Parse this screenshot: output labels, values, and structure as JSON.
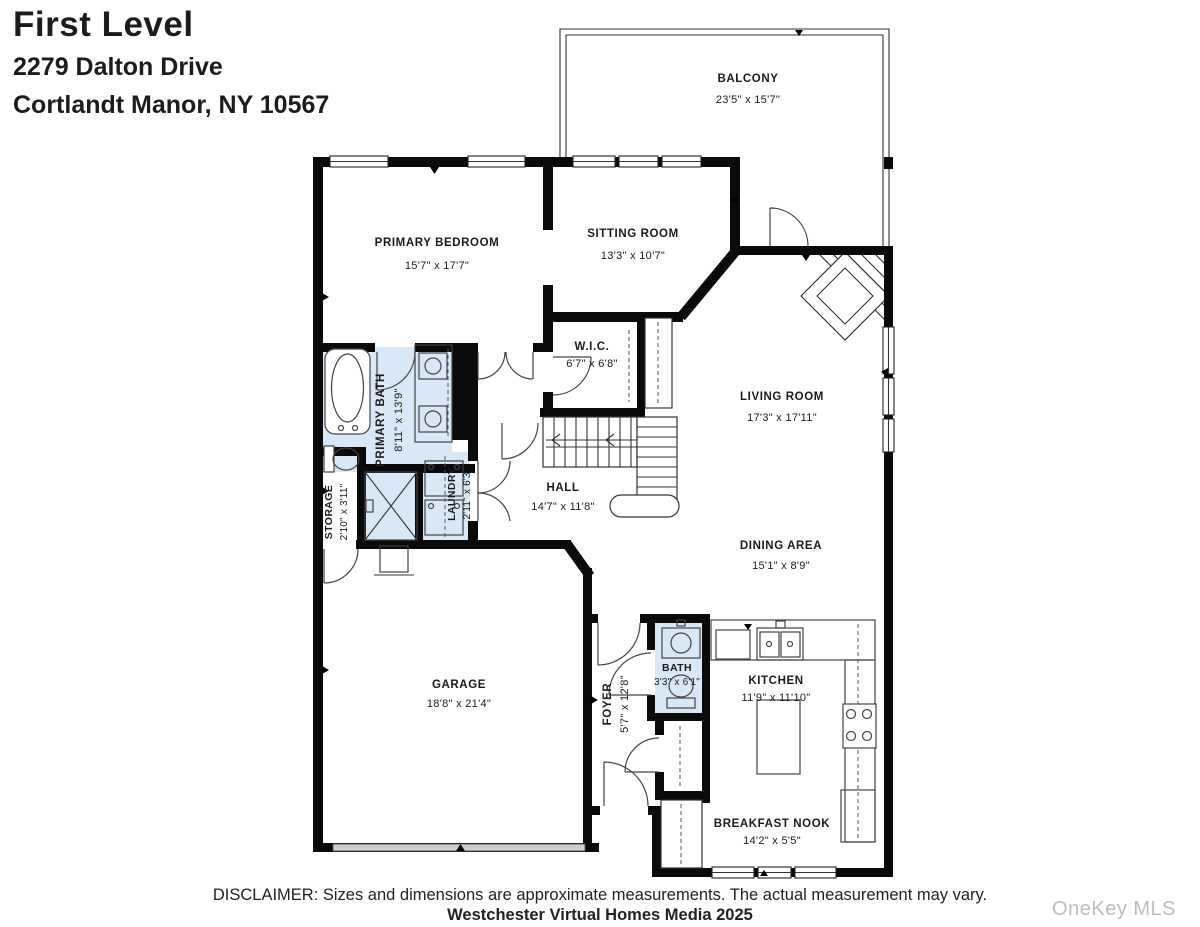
{
  "header": {
    "title": "First Level",
    "address_line1": "2279 Dalton Drive",
    "address_line2": "Cortlandt Manor, NY 10567"
  },
  "rooms": {
    "balcony": {
      "name": "BALCONY",
      "dims": "23'5\" x 15'7\""
    },
    "primary_bedroom": {
      "name": "PRIMARY BEDROOM",
      "dims": "15'7\" x 17'7\""
    },
    "sitting_room": {
      "name": "SITTING ROOM",
      "dims": "13'3\" x 10'7\""
    },
    "wic": {
      "name": "W.I.C.",
      "dims": "6'7\" x 6'8\""
    },
    "living_room": {
      "name": "LIVING ROOM",
      "dims": "17'3\" x 17'11\""
    },
    "primary_bath": {
      "name": "PRIMARY BATH",
      "dims": "8'11\" x 13'9\""
    },
    "storage": {
      "name": "STORAGE",
      "dims": "2'10\" x 3'11\""
    },
    "laundry": {
      "name": "LAUNDRY",
      "dims": "2'11\" x 6'3\""
    },
    "hall": {
      "name": "HALL",
      "dims": "14'7\" x 11'8\""
    },
    "dining_area": {
      "name": "DINING AREA",
      "dims": "15'1\" x 8'9\""
    },
    "garage": {
      "name": "GARAGE",
      "dims": "18'8\" x 21'4\""
    },
    "foyer": {
      "name": "FOYER",
      "dims": "5'7\" x 12'8\""
    },
    "bath": {
      "name": "BATH",
      "dims": "3'3\" x 6'1\""
    },
    "kitchen": {
      "name": "KITCHEN",
      "dims": "11'9\" x 11'10\""
    },
    "breakfast_nook": {
      "name": "BREAKFAST NOOK",
      "dims": "14'2\" x 5'5\""
    }
  },
  "footer": {
    "disclaimer": "DISCLAIMER: Sizes and dimensions are approximate measurements. The actual measurement may vary.",
    "credit": "Westchester Virtual Homes Media 2025",
    "watermark": "OneKey MLS"
  },
  "colors": {
    "wall": "#0a0a0a",
    "wet_room_fill": "#d9e8f6",
    "watermark": "#bdbdbd"
  }
}
